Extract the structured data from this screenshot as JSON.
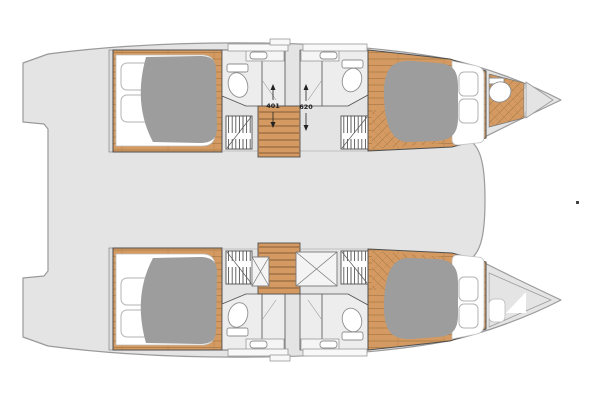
{
  "diagram": {
    "type": "catamaran-interior-deck-plan",
    "dimension_labels": {
      "left": "401",
      "right": "620"
    }
  },
  "colors": {
    "background": "#ffffff",
    "deck": "#e4e4e4",
    "deck_outline": "#9a9a9a",
    "wood": "#d49a62",
    "wood_line": "#aa7a45",
    "duvet": "#9d9d9d",
    "bath_floor": "#ededed",
    "wall": "#4f4f4f",
    "fixture_outline": "#8f8f8f",
    "dim_text": "#222222"
  }
}
